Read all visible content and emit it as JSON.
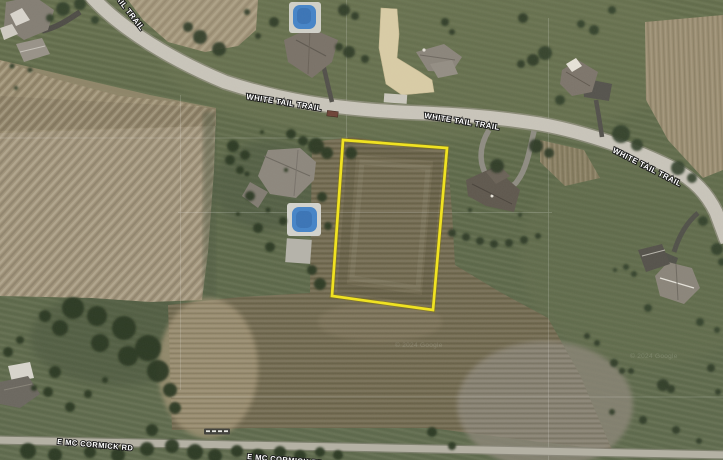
{
  "map": {
    "description": "aerial satellite view of rural parcels",
    "parcel_outline_color": "#f2e41d",
    "road_labels": [
      {
        "id": "white-tail-trail-nw",
        "text": "WHITE TAIL TRAIL"
      },
      {
        "id": "white-tail-trail-mid",
        "text": "WHITE TAIL TRAIL"
      },
      {
        "id": "white-tail-trail-e",
        "text": "WHITE TAIL TRAIL"
      },
      {
        "id": "e-mc-cormick-rd-w",
        "text": "E MC CORMICK RD"
      },
      {
        "id": "e-mc-cormick-rd-e",
        "text": "E MC CORMICK RD"
      }
    ],
    "watermarks": [
      {
        "text": "© 2024 Google"
      },
      {
        "text": "© 2024 Google"
      }
    ]
  }
}
